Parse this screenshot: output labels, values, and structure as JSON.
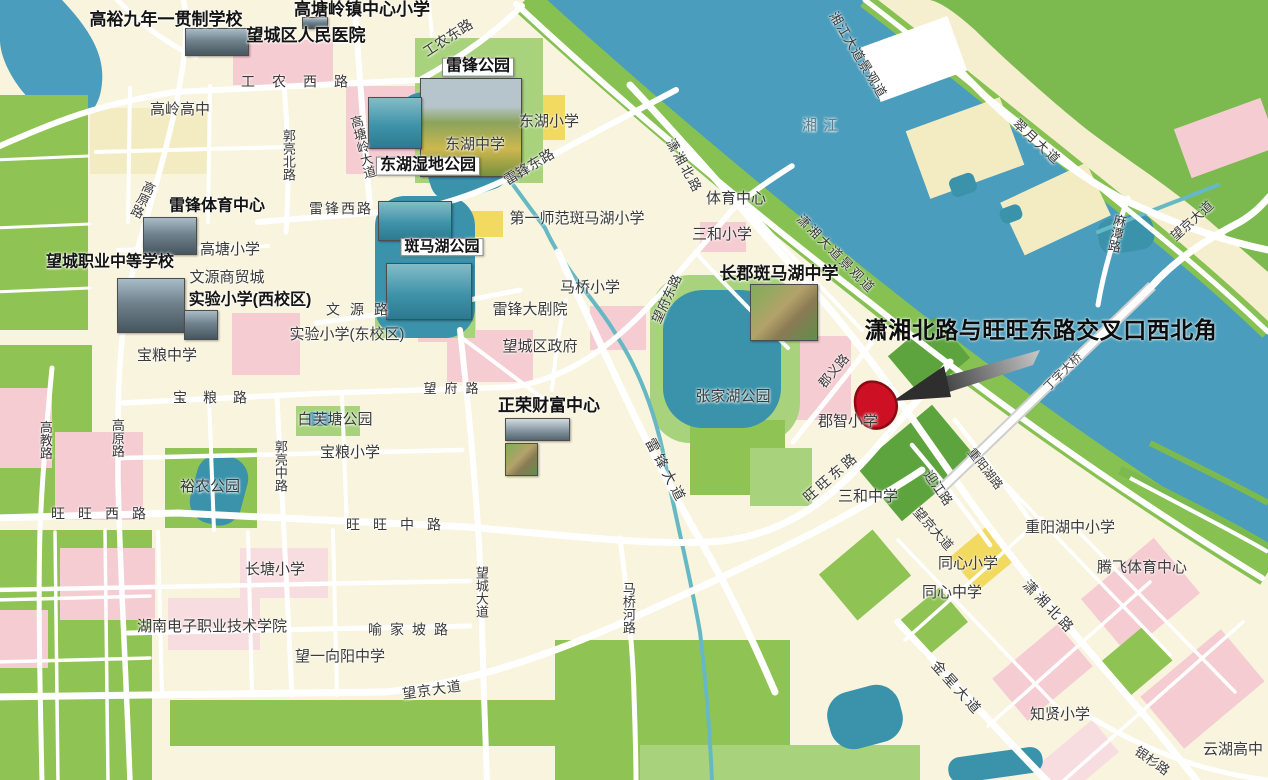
{
  "map": {
    "region_name": "望城区",
    "river_name": "湘江",
    "callout": {
      "text": "潇湘北路与旺旺东路交叉口西北角",
      "x": 1041,
      "y": 328,
      "size": 23,
      "color": "#0d0d0d"
    },
    "marker": {
      "label": "target-site",
      "fill": "#ce1024",
      "stroke": "#8a0a16"
    },
    "arrow": {
      "head_color": "#2e2e2e",
      "tail_dark": "#3c3c3c",
      "tail_light": "#c9c9c9"
    },
    "palette": {
      "cream": "#f8f4de",
      "paleyellow": "#f3ecc3",
      "yellow": "#f2d95f",
      "pink": "#f5ccd2",
      "pink2": "#f8dde0",
      "green": "#8fc353",
      "green2": "#a8d37c",
      "darkgreen": "#5da43e",
      "eastgreen": "#7cba50",
      "bankgreen": "#86c152",
      "eastband": "#f6efcf",
      "water": "#4a9dbc",
      "lake": "#3a93ab",
      "stream": "#66b9c4",
      "road": "#ffffff",
      "white": "#ffffff",
      "bridge_casing": "#cfcfcf"
    },
    "labels": [
      {
        "id": "gaoyu-school",
        "t": "高裕九年一贯制学校",
        "x": 166,
        "y": 20,
        "s": 17,
        "b": 1
      },
      {
        "id": "gtl-town-center-primary",
        "t": "高塘岭镇中心小学",
        "x": 362,
        "y": 10,
        "s": 17,
        "b": 1
      },
      {
        "id": "wangcheng-peoples-hospital",
        "t": "望城区人民医院",
        "x": 306,
        "y": 36,
        "s": 17,
        "b": 1
      },
      {
        "id": "leifeng-park",
        "t": "雷锋公园",
        "x": 478,
        "y": 67,
        "s": 16,
        "b": 1,
        "box": 1
      },
      {
        "id": "donghu-wetland-park",
        "t": "东湖湿地公园",
        "x": 428,
        "y": 166,
        "s": 16,
        "b": 1,
        "box": 1
      },
      {
        "id": "leifeng-sports-center",
        "t": "雷锋体育中心",
        "x": 217,
        "y": 207,
        "s": 16,
        "b": 1
      },
      {
        "id": "wangcheng-vocational-school",
        "t": "望城职业中等学校",
        "x": 110,
        "y": 263,
        "s": 16,
        "b": 1
      },
      {
        "id": "experimental-primary-west",
        "t": "实验小学(西校区)",
        "x": 250,
        "y": 301,
        "s": 16,
        "b": 1
      },
      {
        "id": "banmahu-park",
        "t": "斑马湖公园",
        "x": 442,
        "y": 247,
        "s": 15,
        "b": 1,
        "box": 1
      },
      {
        "id": "changjun-banmahu-middle",
        "t": "长郡斑马湖中学",
        "x": 779,
        "y": 274,
        "s": 17,
        "b": 1
      },
      {
        "id": "zhengrong-wealth-center",
        "t": "正荣财富中心",
        "x": 549,
        "y": 406,
        "s": 17,
        "b": 1
      },
      {
        "id": "gaoling-high",
        "t": "高岭高中",
        "x": 180,
        "y": 110,
        "s": 15
      },
      {
        "id": "gaotang-primary",
        "t": "高塘小学",
        "x": 230,
        "y": 250,
        "s": 15
      },
      {
        "id": "wenyuan-trade-city",
        "t": "文源商贸城",
        "x": 227,
        "y": 278,
        "s": 15
      },
      {
        "id": "experimental-primary-east",
        "t": "实验小学(东校区)",
        "x": 347,
        "y": 335,
        "s": 15
      },
      {
        "id": "baoliang-middle",
        "t": "宝粮中学",
        "x": 167,
        "y": 356,
        "s": 15
      },
      {
        "id": "donghu-primary",
        "t": "东湖小学",
        "x": 549,
        "y": 122,
        "s": 15
      },
      {
        "id": "donghu-middle",
        "t": "东湖中学",
        "x": 475,
        "y": 145,
        "s": 15
      },
      {
        "id": "first-normal-banmahu-primary",
        "t": "第一师范斑马湖小学",
        "x": 577,
        "y": 219,
        "s": 15
      },
      {
        "id": "maqiao-primary",
        "t": "马桥小学",
        "x": 590,
        "y": 288,
        "s": 15
      },
      {
        "id": "leifeng-grand-theatre",
        "t": "雷锋大剧院",
        "x": 530,
        "y": 310,
        "s": 15
      },
      {
        "id": "wangcheng-district-govt",
        "t": "望城区政府",
        "x": 540,
        "y": 347,
        "s": 15
      },
      {
        "id": "sanhe-primary",
        "t": "三和小学",
        "x": 722,
        "y": 235,
        "s": 15
      },
      {
        "id": "sports-center",
        "t": "体育中心",
        "x": 736,
        "y": 199,
        "s": 15
      },
      {
        "id": "zhangjiahu-park",
        "t": "张家湖公园",
        "x": 733,
        "y": 397,
        "s": 15
      },
      {
        "id": "baifutang-park",
        "t": "白芙塘公园",
        "x": 335,
        "y": 420,
        "s": 15
      },
      {
        "id": "baoliang-primary",
        "t": "宝粮小学",
        "x": 350,
        "y": 453,
        "s": 15
      },
      {
        "id": "yunong-park",
        "t": "裕农公园",
        "x": 210,
        "y": 487,
        "s": 15
      },
      {
        "id": "changtang-primary",
        "t": "长塘小学",
        "x": 275,
        "y": 570,
        "s": 15
      },
      {
        "id": "hunan-electronic-college",
        "t": "湖南电子职业技术学院",
        "x": 212,
        "y": 627,
        "s": 15
      },
      {
        "id": "wangyi-xiangyang-middle",
        "t": "望一向阳中学",
        "x": 340,
        "y": 657,
        "s": 15
      },
      {
        "id": "junzhi-primary",
        "t": "郡智小学",
        "x": 848,
        "y": 422,
        "s": 15
      },
      {
        "id": "sanhe-middle",
        "t": "三和中学",
        "x": 868,
        "y": 497,
        "s": 15
      },
      {
        "id": "tongxin-primary",
        "t": "同心小学",
        "x": 968,
        "y": 564,
        "s": 15
      },
      {
        "id": "tongxin-middle",
        "t": "同心中学",
        "x": 952,
        "y": 593,
        "s": 15
      },
      {
        "id": "chongyanghu-school",
        "t": "重阳湖中小学",
        "x": 1070,
        "y": 528,
        "s": 15
      },
      {
        "id": "tengfei-sports-center",
        "t": "腾飞体育中心",
        "x": 1142,
        "y": 568,
        "s": 15
      },
      {
        "id": "zhixian-primary",
        "t": "知贤小学",
        "x": 1060,
        "y": 715,
        "s": 15
      },
      {
        "id": "yunhu-high",
        "t": "云湖高中",
        "x": 1233,
        "y": 750,
        "s": 15
      },
      {
        "id": "xiangjiang-river",
        "t": "湘江",
        "x": 823,
        "y": 126,
        "s": 15,
        "c": "#5f7d8c",
        "ls": 6
      },
      {
        "id": "gongnong-west-rd",
        "t": "工农西路",
        "x": 303,
        "y": 82,
        "s": 14,
        "ls": 17
      },
      {
        "id": "gongnong-east-rd",
        "t": "工农东路",
        "x": 448,
        "y": 38,
        "s": 14,
        "r": -33
      },
      {
        "id": "gaoyuan-rd-n",
        "t": "高原路",
        "x": 142,
        "y": 199,
        "s": 13,
        "v": 1,
        "r": 25
      },
      {
        "id": "guoliang-north-rd",
        "t": "郭亮北路",
        "x": 288,
        "y": 155,
        "s": 13,
        "v": 1
      },
      {
        "id": "gaotangling-ave",
        "t": "高塘岭大道",
        "x": 362,
        "y": 147,
        "s": 13,
        "v": 1,
        "r": -14
      },
      {
        "id": "leifeng-west-rd",
        "t": "雷锋西路",
        "x": 341,
        "y": 209,
        "s": 14,
        "ls": 2
      },
      {
        "id": "leifeng-east-rd",
        "t": "雷锋东路",
        "x": 529,
        "y": 167,
        "s": 14,
        "r": -31
      },
      {
        "id": "xiaoxiang-north-rd-n",
        "t": "潇湘北路",
        "x": 684,
        "y": 166,
        "s": 13,
        "r": 61,
        "ls": 2
      },
      {
        "id": "wenyuan-rd",
        "t": "文源路",
        "x": 362,
        "y": 310,
        "s": 14,
        "ls": 10
      },
      {
        "id": "baoliang-rd",
        "t": "宝粮路",
        "x": 218,
        "y": 398,
        "s": 14,
        "ls": 16
      },
      {
        "id": "wangfu-rd",
        "t": "望府路",
        "x": 455,
        "y": 389,
        "s": 13,
        "ls": 8
      },
      {
        "id": "wangfu-east-rd",
        "t": "望府东路",
        "x": 667,
        "y": 299,
        "s": 13,
        "r": -65
      },
      {
        "id": "xiaoxiang-ave-scenic",
        "t": "潇湘大道景观道",
        "x": 836,
        "y": 254,
        "s": 13,
        "r": 45,
        "ls": 2
      },
      {
        "id": "xiangjiang-ave-scenic",
        "t": "湘江大道景观道",
        "x": 858,
        "y": 55,
        "s": 13,
        "r": 59,
        "ls": 1
      },
      {
        "id": "cuiyue-ave",
        "t": "翠月大道",
        "x": 1037,
        "y": 142,
        "s": 13,
        "r": 43,
        "ls": 2
      },
      {
        "id": "dingzi-bridge",
        "t": "丁字大桥",
        "x": 1063,
        "y": 372,
        "s": 12,
        "r": -45,
        "c": "#474747"
      },
      {
        "id": "matan-rd",
        "t": "麻潭路",
        "x": 1116,
        "y": 233,
        "s": 13,
        "v": 1,
        "r": 12
      },
      {
        "id": "wangjing-ave-ne",
        "t": "望京大道",
        "x": 1192,
        "y": 221,
        "s": 13,
        "r": -42
      },
      {
        "id": "junyi-rd",
        "t": "郡义路",
        "x": 834,
        "y": 371,
        "s": 13,
        "r": -50
      },
      {
        "id": "wangwang-east-rd",
        "t": "旺旺东路",
        "x": 831,
        "y": 477,
        "s": 14,
        "r": -41,
        "ls": 3
      },
      {
        "id": "yingjiang-rd",
        "t": "迎江路",
        "x": 938,
        "y": 488,
        "s": 13,
        "r": 55
      },
      {
        "id": "chongyanghu-rd",
        "t": "重阳湖路",
        "x": 985,
        "y": 469,
        "s": 12,
        "r": 52
      },
      {
        "id": "wangjing-ave-mid",
        "t": "望京大道",
        "x": 933,
        "y": 529,
        "s": 13,
        "r": 48
      },
      {
        "id": "xiaoxiang-north-rd-s",
        "t": "潇湘北路",
        "x": 1049,
        "y": 607,
        "s": 14,
        "r": 46,
        "ls": 3
      },
      {
        "id": "jinxing-ave",
        "t": "金星大道",
        "x": 957,
        "y": 688,
        "s": 14,
        "r": 48,
        "ls": 3
      },
      {
        "id": "yinshan-rd",
        "t": "银杉路",
        "x": 1152,
        "y": 761,
        "s": 13,
        "r": 35
      },
      {
        "id": "leifeng-ave",
        "t": "雷锋大道",
        "x": 666,
        "y": 471,
        "s": 14,
        "r": 62,
        "ls": 4
      },
      {
        "id": "wangwang-west-rd",
        "t": "旺旺西路",
        "x": 105,
        "y": 514,
        "s": 14,
        "ls": 13
      },
      {
        "id": "wangwang-mid-rd",
        "t": "旺旺中路",
        "x": 400,
        "y": 525,
        "s": 14,
        "ls": 13
      },
      {
        "id": "gaoyuan-rd-s",
        "t": "高原路",
        "x": 117,
        "y": 438,
        "s": 13,
        "v": 1
      },
      {
        "id": "gaojiao-rd",
        "t": "高教路",
        "x": 45,
        "y": 440,
        "s": 13,
        "v": 1
      },
      {
        "id": "guoliang-mid-rd",
        "t": "郭亮中路",
        "x": 280,
        "y": 466,
        "s": 13,
        "v": 1
      },
      {
        "id": "wangcheng-ave",
        "t": "望城大道",
        "x": 481,
        "y": 592,
        "s": 13,
        "v": 1
      },
      {
        "id": "maqiaohe-rd",
        "t": "马桥河路",
        "x": 628,
        "y": 608,
        "s": 13,
        "v": 1
      },
      {
        "id": "yujiapo-rd",
        "t": "喻家坡路",
        "x": 412,
        "y": 630,
        "s": 14,
        "ls": 8
      },
      {
        "id": "wangjing-ave-sw",
        "t": "望京大道",
        "x": 432,
        "y": 690,
        "s": 14,
        "r": -8,
        "ls": 1
      }
    ],
    "photos": [
      {
        "id": "hospital-photo",
        "x": 302,
        "y": 17,
        "w": 24,
        "h": 10,
        "kind": "campus"
      },
      {
        "id": "gaoyu-school-photo",
        "x": 185,
        "y": 28,
        "w": 62,
        "h": 26,
        "kind": "campus"
      },
      {
        "id": "leifeng-park-photo",
        "x": 420,
        "y": 78,
        "w": 100,
        "h": 97,
        "kind": "park"
      },
      {
        "id": "donghu-wetland-photo",
        "x": 368,
        "y": 97,
        "w": 52,
        "h": 50,
        "kind": "lake"
      },
      {
        "id": "leifeng-sports-photo",
        "x": 143,
        "y": 217,
        "w": 52,
        "h": 36,
        "kind": "campus"
      },
      {
        "id": "vocational-school-photo",
        "x": 117,
        "y": 278,
        "w": 66,
        "h": 53,
        "kind": "campus"
      },
      {
        "id": "wenyuan-photo",
        "x": 184,
        "y": 310,
        "w": 32,
        "h": 28,
        "kind": "campus"
      },
      {
        "id": "banmahu-marina-photo",
        "x": 378,
        "y": 201,
        "w": 72,
        "h": 38,
        "kind": "lake"
      },
      {
        "id": "banmahu-lake-photo",
        "x": 386,
        "y": 263,
        "w": 84,
        "h": 55,
        "kind": "lake"
      },
      {
        "id": "changjun-school-photo",
        "x": 750,
        "y": 284,
        "w": 66,
        "h": 55,
        "kind": "aerial"
      },
      {
        "id": "zhengrong-pano-photo",
        "x": 505,
        "y": 418,
        "w": 63,
        "h": 21,
        "kind": "tower"
      },
      {
        "id": "zhengrong-aerial-photo",
        "x": 505,
        "y": 443,
        "w": 31,
        "h": 31,
        "kind": "aerial"
      }
    ]
  }
}
